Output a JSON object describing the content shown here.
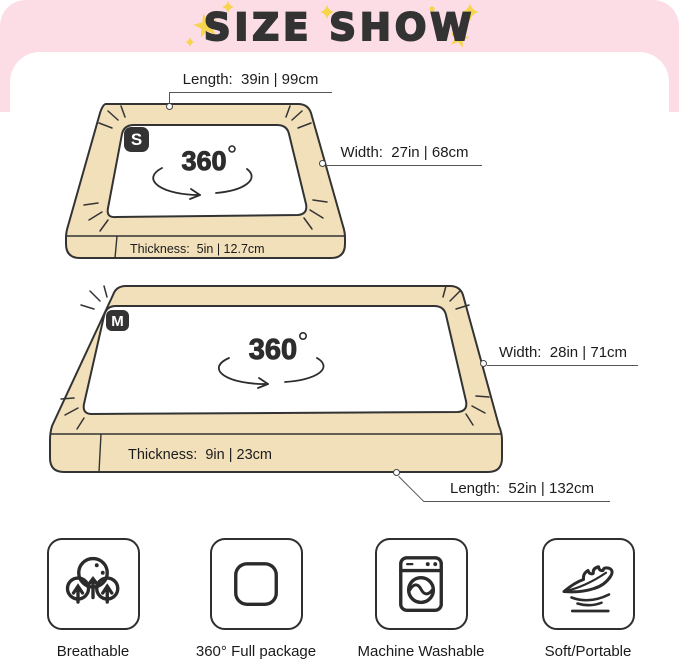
{
  "header": {
    "title": "SIZE SHOW"
  },
  "size_s": {
    "badge": "S",
    "rotation": "360",
    "length_label": "Length:  39in | 99cm",
    "width_label": "Width:  27in | 68cm",
    "thickness_label": "Thickness:  5in | 12.7cm"
  },
  "size_m": {
    "badge": "M",
    "rotation": "360",
    "width_label": "Width:  28in | 71cm",
    "thickness_label": "Thickness:  9in | 23cm",
    "length_label": "Length:  52in | 132cm"
  },
  "features": [
    {
      "icon": "breathable-icon",
      "label": "Breathable"
    },
    {
      "icon": "full-package-icon",
      "label": "360° Full package"
    },
    {
      "icon": "machine-washable-icon",
      "label": "Machine Washable"
    },
    {
      "icon": "feather-icon",
      "label": "Soft/Portable"
    }
  ],
  "colors": {
    "header_bg": "#fcdde6",
    "star": "#f6d44c",
    "title_text": "#333333",
    "bed_fill": "#f2e0bb",
    "outline": "#333333",
    "badge_bg": "#333333",
    "label_text": "#1c1c1c"
  }
}
